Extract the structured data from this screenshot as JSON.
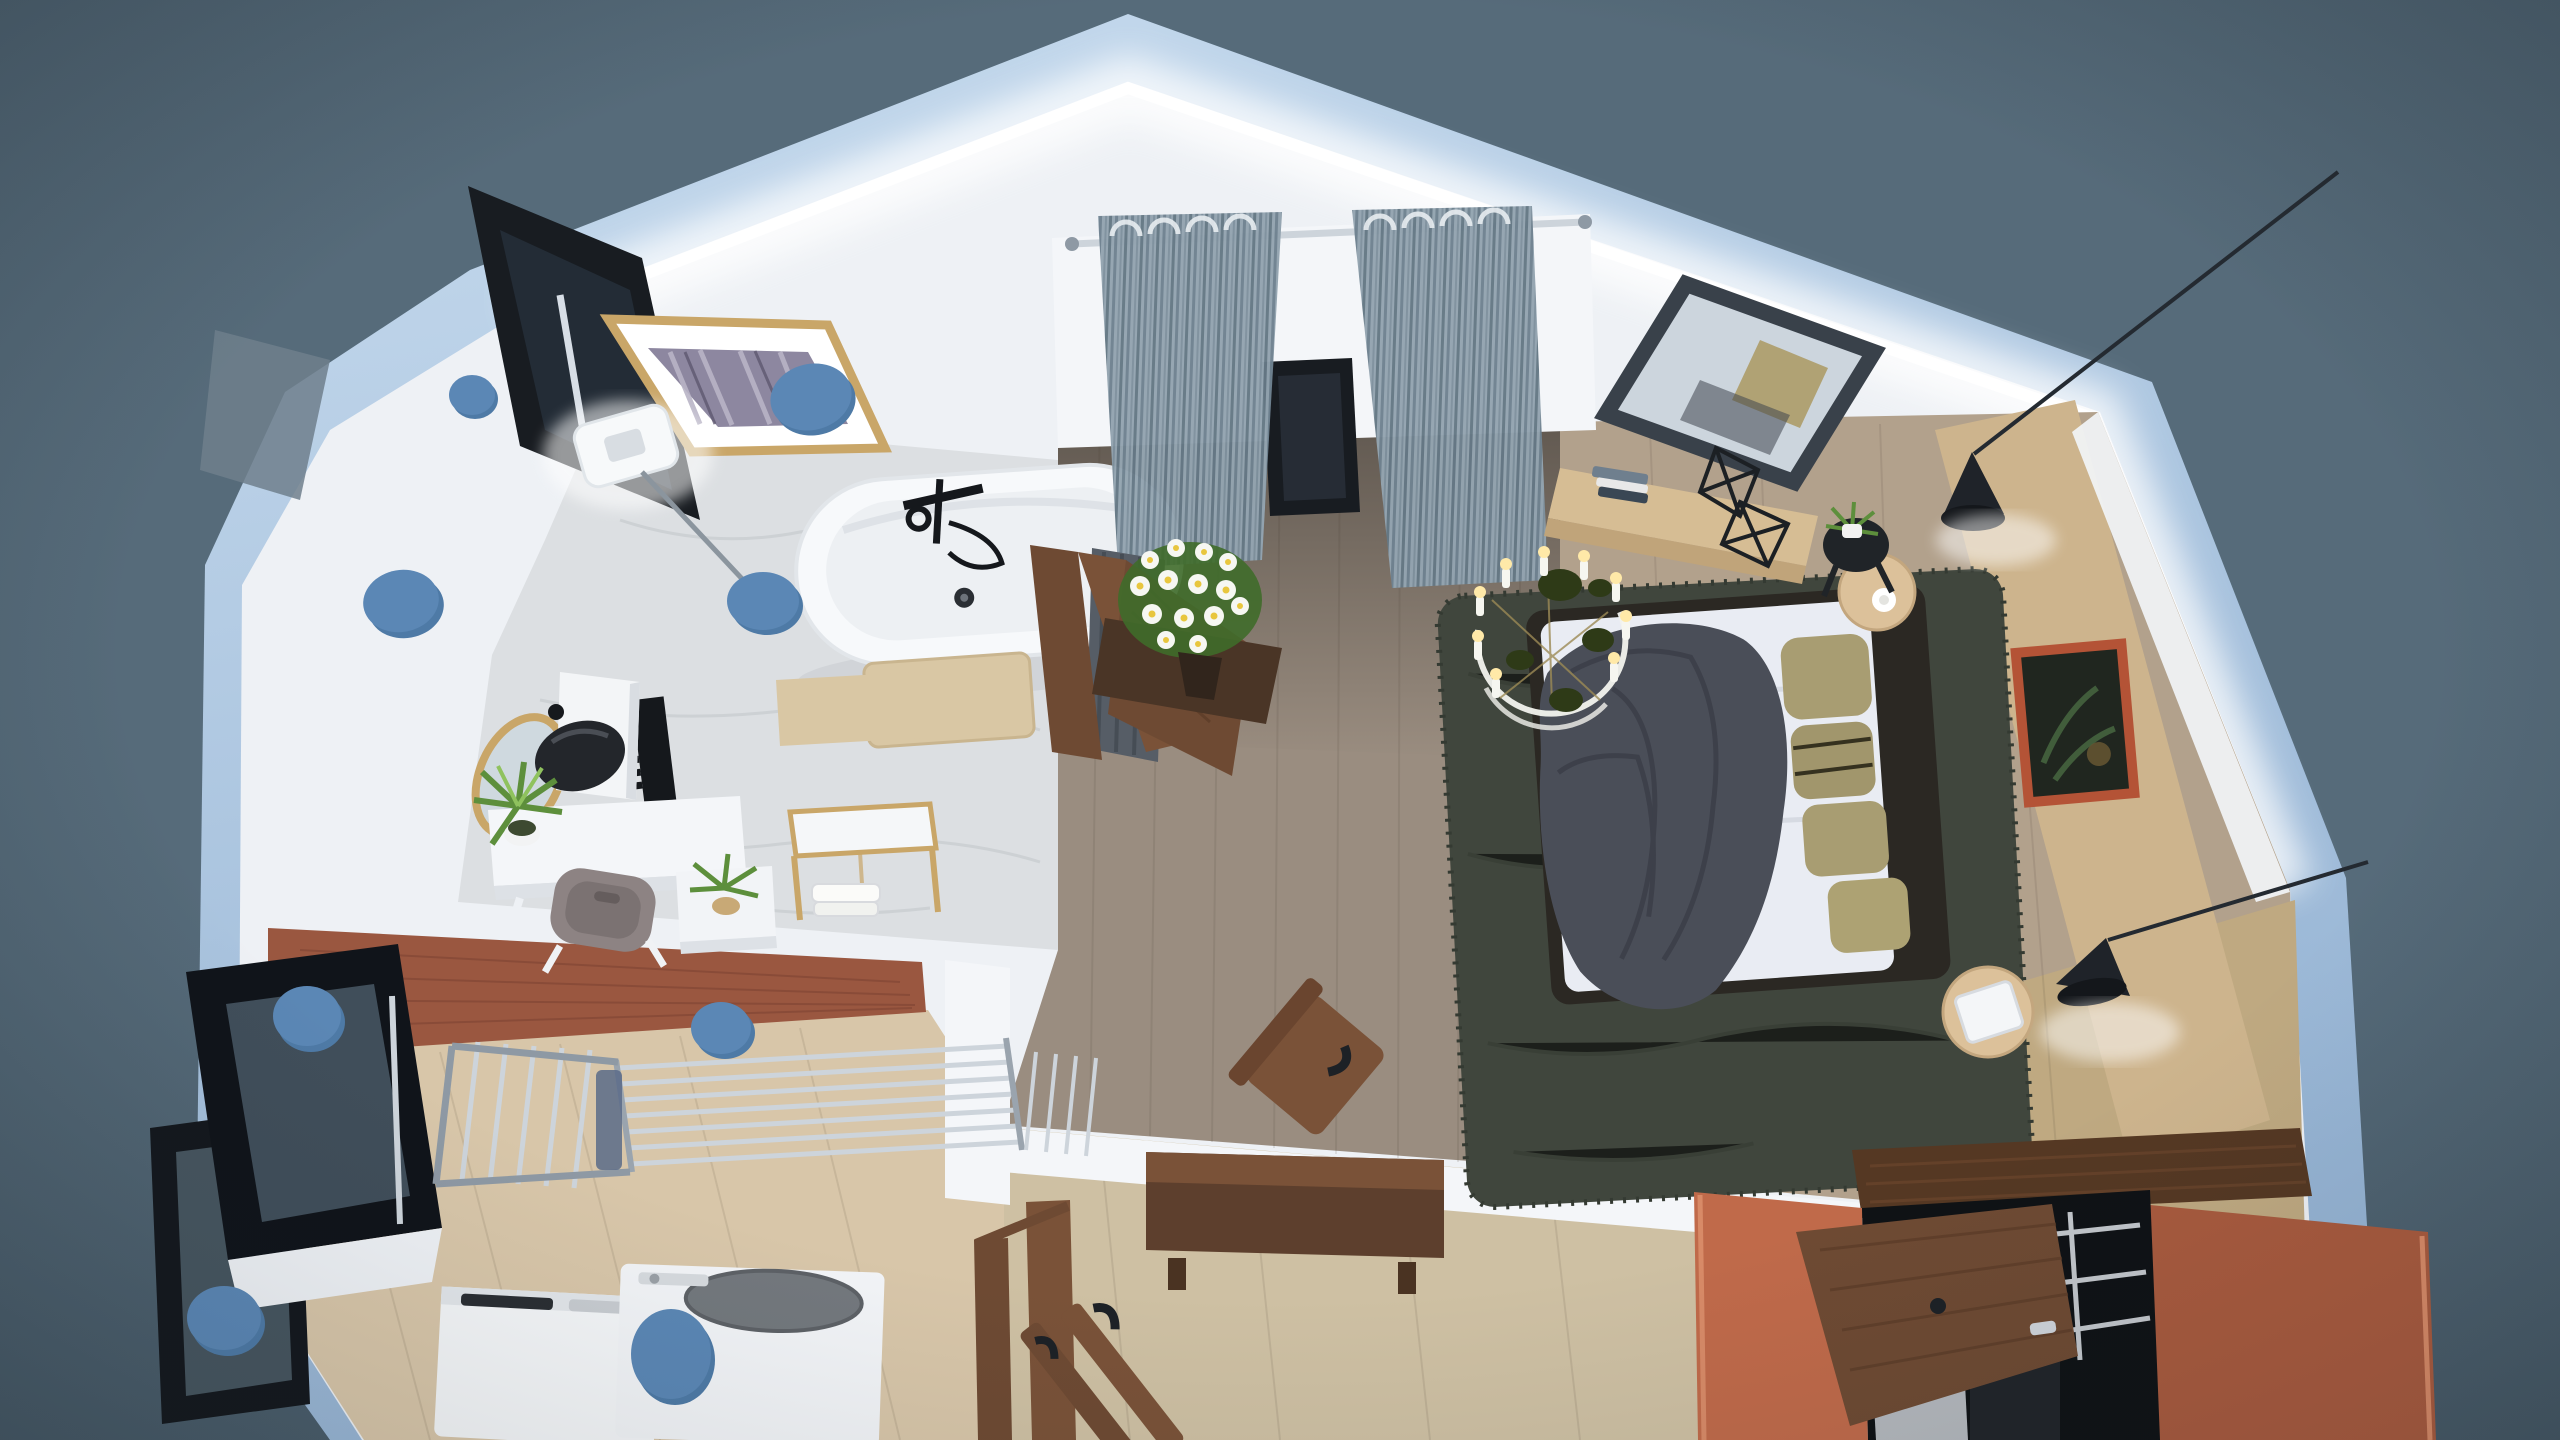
{
  "meta": {
    "scene_title": "Attic apartment - 3D dollhouse cutaway floor plan render, top-down view",
    "render_style": "photoreal interior render with gabled roof cutaway on slate backdrop"
  },
  "palette": {
    "backdrop": "#566b7a",
    "backdrop_dark": "#4c5e6b",
    "roof_band": "#aac4e0",
    "roof_band_deep": "#8fb0d4",
    "interior_white": "#eef1f5",
    "wall_white": "#f4f6f9",
    "marble": "#dcdfe2",
    "marble_vein": "#c6cacf",
    "wood_hall": "#9a8d80",
    "wood_bedroom": "#b2a18c",
    "wood_laundry": "#d8c6a9",
    "wood_entry": "#cec0a3",
    "rug_green": "#40463d",
    "rug_green_dark": "#343a32",
    "duvet_white": "#e9ecf3",
    "throw_gray": "#4a4e58",
    "pillow_olive": "#a89d72",
    "bed_frame": "#2b2823",
    "tan_wall": "#cdb48d",
    "carpet_tan": "#bfa981",
    "orange_panel": "#c06a4a",
    "orange_panel_dark": "#a85a3e",
    "terracotta": "#9a5740",
    "walnut": "#6e4a33",
    "walnut_dark": "#553823",
    "gold": "#c9a668",
    "chrome": "#cdd4db",
    "chrome_dark": "#8e99a4",
    "ink_black": "#181c21",
    "frosted": "#f7f9fa",
    "curtain": "#93a4b0",
    "curtain_stripe": "#6f8290",
    "marker_blue": "#5b87b5",
    "marker_blue_dark": "#4e7aa6",
    "plant_green": "#5d8f3c",
    "flower_white": "#f6f7f2",
    "flower_yellow": "#e8c63e",
    "art_violet": "#8d87a0",
    "art_frame_orange": "#b45336",
    "art_dark": "#20261f",
    "glass_slate": "#46555f",
    "towel_beige": "#d9c7a4",
    "gray_chair": "#8d8383"
  },
  "rooms": [
    {
      "id": "bathroom",
      "label": "Bathroom (marble floor, freestanding tub)"
    },
    {
      "id": "hallway",
      "label": "Hallway with curtained balcony door"
    },
    {
      "id": "bedroom",
      "label": "Bedroom (bed, rug, chandelier)"
    },
    {
      "id": "laundry",
      "label": "Laundry room (washer, dryer, drying rack)"
    },
    {
      "id": "closet",
      "label": "Walk-in closet with orange sliding panels"
    },
    {
      "id": "entry",
      "label": "Entry hall with console"
    }
  ],
  "objects": {
    "scene": "Attic apartment - 3D dollhouse cutaway floor plan render",
    "roof": "Gabled roof cutaway edge with LED glow",
    "roof_window": "Open roof skylight window",
    "gold_art": "Gold framed abstract artwork on sloped wall",
    "wall_lamp": "Frosted square wall lamp",
    "bathtub": "Freestanding white bathtub with black faucet",
    "bath_mat": "Beige bath mat",
    "towel_radiator": "Black towel radiator",
    "vanity_mirror": "Gold capsule mirror",
    "vessel_sink": "Black vessel sink on white column",
    "vanity_desk": "White vanity desk",
    "vanity_chair": "Gray upholstered chair",
    "potted_plant": "Green potted plant",
    "towel_stand": "Gold towel stand with white towels",
    "floor_mat": "Beige floor mat",
    "curtains": "Gray striped grommet curtains on chrome rod",
    "balcony_door": "Dark balcony doorway",
    "flowers": "White daffodil bouquet",
    "bathroom_door": "Open walnut bathroom door",
    "area_rug": "Dark green shag area rug",
    "bed": "Double bed with white duvet, gray throw and olive pillows",
    "chandelier": "Ring chandelier with candle lights and dark leaves",
    "nightstand": "Round wooden side stool",
    "stool_pad": "Round stool with white cushion",
    "leaning_mirror": "Dark framed leaning mirror",
    "console_desk": "Floating light-wood dressing console",
    "decor_books": "Stacked books",
    "decor_geometric": "Black wire geometric decor",
    "side_table": "Black side table with plant",
    "pendant_lamp": "Black teardrop pendant lamp on long cable",
    "bed_art": "Terracotta framed artwork",
    "accent_wall": "Tan headboard accent wall",
    "closet_panels": "Orange sliding closet panels",
    "wardrobe": "Walnut wardrobe with open door",
    "hall_console": "Walnut console table",
    "wooden_chair": "Walnut chair",
    "entry_door": "Open walnut entry door",
    "drying_rack": "Chrome clothes drying rack",
    "washer": "White top-load washing machine",
    "dryer": "White top-load dryer with gray lid",
    "casement_window": "Black open casement window",
    "light_marker": "Blue light / camera position marker"
  },
  "markers": {
    "color": "#5b87b5",
    "count": 9,
    "positions_px": [
      [
        472,
        395
      ],
      [
        812,
        398
      ],
      [
        402,
        602
      ],
      [
        764,
        602
      ],
      [
        722,
        1030
      ],
      [
        308,
        1018
      ],
      [
        225,
        1320
      ],
      [
        672,
        1356
      ],
      [
        1124,
        676
      ]
    ]
  }
}
